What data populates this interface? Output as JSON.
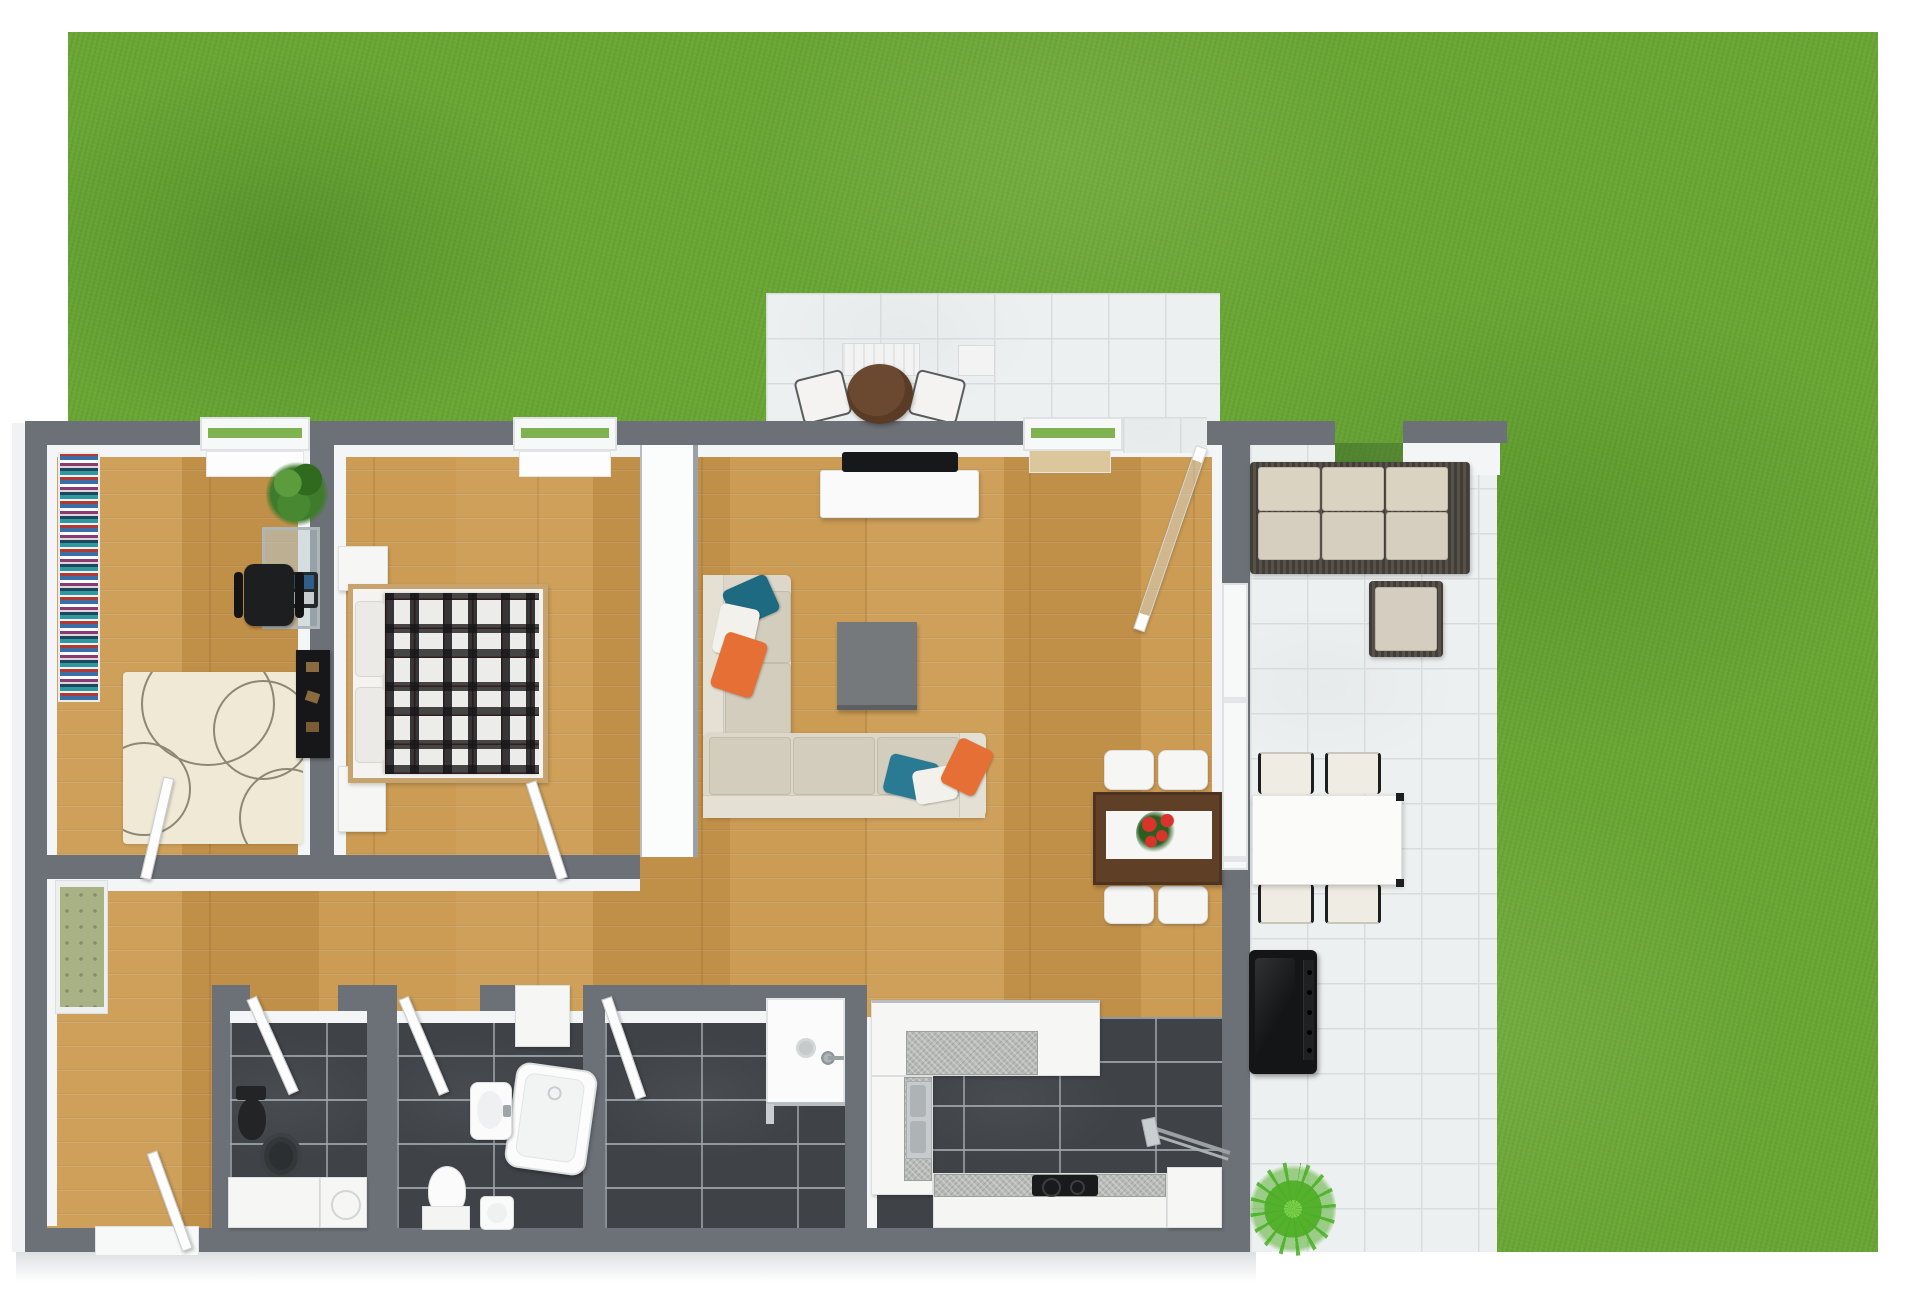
{
  "app": {
    "title": "3D Floor Plan Rendering — Top-Down View",
    "kind": "floorplan-render",
    "visible_text": []
  },
  "colors": {
    "page": "#ffffff",
    "grass": "#6aa735",
    "wall": "#6c7177",
    "wall_face": "#f4f5f6",
    "wood": "#c9984f",
    "tile_dark": "#3f4347",
    "patio": "#edf0f0",
    "patio_grout": "#d8dcdc",
    "sofa_beige": "#dcd7c9",
    "pillow_teal": "#1e6a80",
    "pillow_blue": "#2a7a94",
    "pillow_orange": "#e66f35",
    "rug_cream": "#efe9d6",
    "bench_green": "#a9b285",
    "dining_wood": "#5f4026",
    "bistro_wood": "#5a3c26",
    "wicker": "#57514a",
    "cushion": "#d6cfbf",
    "grill_black": "#141516",
    "bed_frame": "#c7a36e",
    "coffee_table_gray": "#75797c",
    "flower_red": "#d8342c"
  },
  "scene": {
    "garden": {
      "ground": "lawn",
      "patios": [
        "top-patio-tiled",
        "right-patio-tiled"
      ]
    },
    "rooms": [
      {
        "name": "office",
        "floor": "wood",
        "furniture": [
          "bookshelf-with-books",
          "potted-plant",
          "glass-desk",
          "laptop",
          "black-office-chair",
          "dark-dresser",
          "cream-circle-rug",
          "door"
        ]
      },
      {
        "name": "bedroom",
        "floor": "wood",
        "furniture": [
          "double-bed-plaid-blanket",
          "wardrobe",
          "nightstand",
          "window",
          "door"
        ]
      },
      {
        "name": "living-dining",
        "floor": "wood",
        "furniture": [
          "tv",
          "tv-console",
          "corner-sofa",
          "throw-pillows",
          "coffee-table",
          "dining-table-dark-wood",
          "table-runner-with-red-flowers",
          "four-white-chairs",
          "window-bench",
          "open-glass-door"
        ]
      },
      {
        "name": "hallway",
        "floor": "wood",
        "furniture": [
          "green-bench",
          "front-door"
        ]
      },
      {
        "name": "bathroom-1",
        "floor": "dark-tile",
        "furniture": [
          "black-toilet",
          "dark-round-rug",
          "white-vanity",
          "washing-machine",
          "door"
        ]
      },
      {
        "name": "bathroom-2",
        "floor": "dark-tile",
        "furniture": [
          "washbasin",
          "corner-bathtub",
          "toilet",
          "bidet",
          "tall-cabinet",
          "door"
        ]
      },
      {
        "name": "shower-room",
        "floor": "dark-tile",
        "furniture": [
          "shower-cabin",
          "shower-head",
          "door"
        ]
      },
      {
        "name": "kitchen",
        "floor": "dark-tile",
        "furniture": [
          "l-shaped-counter",
          "granite-worktop",
          "double-sink",
          "cooktop",
          "corner-cabinet",
          "drying-rack"
        ]
      }
    ],
    "outdoor_furniture": [
      "bistro-round-table",
      "two-bistro-chairs",
      "two-patio-storage-boxes",
      "wicker-lounge-sofa-3-seats",
      "wicker-ottoman",
      "outdoor-dining-table-white",
      "four-outdoor-chairs",
      "bbq-grill",
      "fern-plant"
    ]
  }
}
